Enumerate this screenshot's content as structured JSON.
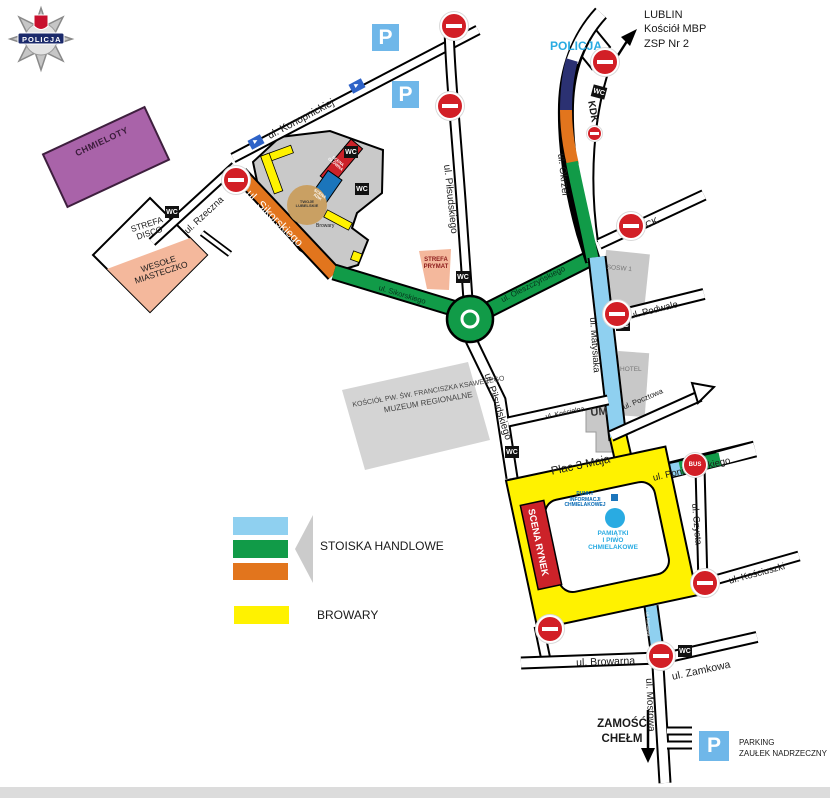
{
  "logo": {
    "banner": "POLICJA"
  },
  "top": {
    "policja": "POLICJA",
    "kdk": "KDK",
    "lublin": [
      "LUBLIN",
      "Kościół MBP",
      "ZSP Nr 2"
    ]
  },
  "streets": {
    "konopnickiej": "ul. Konopnickiej",
    "pilsudskiego_n": "ul. Piłsudskiego",
    "pilsudskiego_s": "ul. Piłsudskiego",
    "rzeczna": "ul. Rzeczna",
    "sikorskiego_orange": "ul. Sikorskiego",
    "sikorskiego_green": "ul. Sikorskiego",
    "oleszczynskiego": "ul. Oleszczyńskiego",
    "okrzei": "ul. Okrzei",
    "pck": "ul. PCK",
    "podwale": "ul. Podwale",
    "matysiaka": "ul. Matysiaka",
    "pocztowa": "ul. Pocztowa",
    "koscielna": "ul. Kościelna",
    "plac3maja": "Plac 3 Maja",
    "poniatowskiego": "ul. Poniatowskiego",
    "czysta": "ul. Czysta",
    "kosciuszki": "ul. Kościuszki",
    "browarna": "ul. Browarna",
    "zamkowa": "ul. Zamkowa",
    "mostowa": "ul. Mostowa",
    "mostowa_blue": "ul. Mostowa"
  },
  "zones": {
    "chmieloty": "CHMIELOTY",
    "disco": [
      "STREFA",
      "DISCO"
    ],
    "miasteczko": [
      "WESOŁE",
      "MIASTECZKO"
    ],
    "prymat": [
      "STREFA",
      "PRYMAT"
    ],
    "kosciol": [
      "KOŚCIÓŁ PW. ŚW. FRANCISZKA KSAWEREGO",
      "MUZEUM REGIONALNE"
    ],
    "sosw": "SOSW 1",
    "hotel": "HOTEL",
    "um": "UM"
  },
  "stage": {
    "main": [
      "SCENA",
      "GŁÓWNA"
    ],
    "blue": [
      "SCENA",
      "KDK"
    ],
    "round": [
      "TWOJE",
      "LUBELSKIE"
    ],
    "browary": "Browary"
  },
  "rynek": {
    "scena": "SCENA RYNEK",
    "punkt": [
      "PUNKT",
      "INFORMACJI",
      "CHMIELAKOWEJ"
    ],
    "pamiatki": [
      "PAMIĄTKI",
      "I PIWO",
      "CHMIELAKOWE"
    ]
  },
  "legend": {
    "stoiska": "STOISKA HANDLOWE",
    "browary": "BROWARY"
  },
  "badges": {
    "wc": "WC",
    "p": "P",
    "bus": "BUS"
  },
  "south": {
    "zamosc": [
      "ZAMOŚĆ",
      "CHEŁM"
    ],
    "parking": [
      "PARKING",
      "ZAUŁEK NADRZECZNY"
    ]
  },
  "colors": {
    "street_blue": "#8FD0F0",
    "street_green": "#119B48",
    "street_orange": "#E2751D",
    "zone_yellow": "#FFF200",
    "purple": "#A963A9",
    "salmon": "#F4B89C",
    "stage_red": "#CC2229",
    "navy_segment": "#2B3172",
    "cyan_text": "#29ABE2",
    "parking_blue": "#6FB7E9",
    "noentry_red": "#D21F26"
  }
}
